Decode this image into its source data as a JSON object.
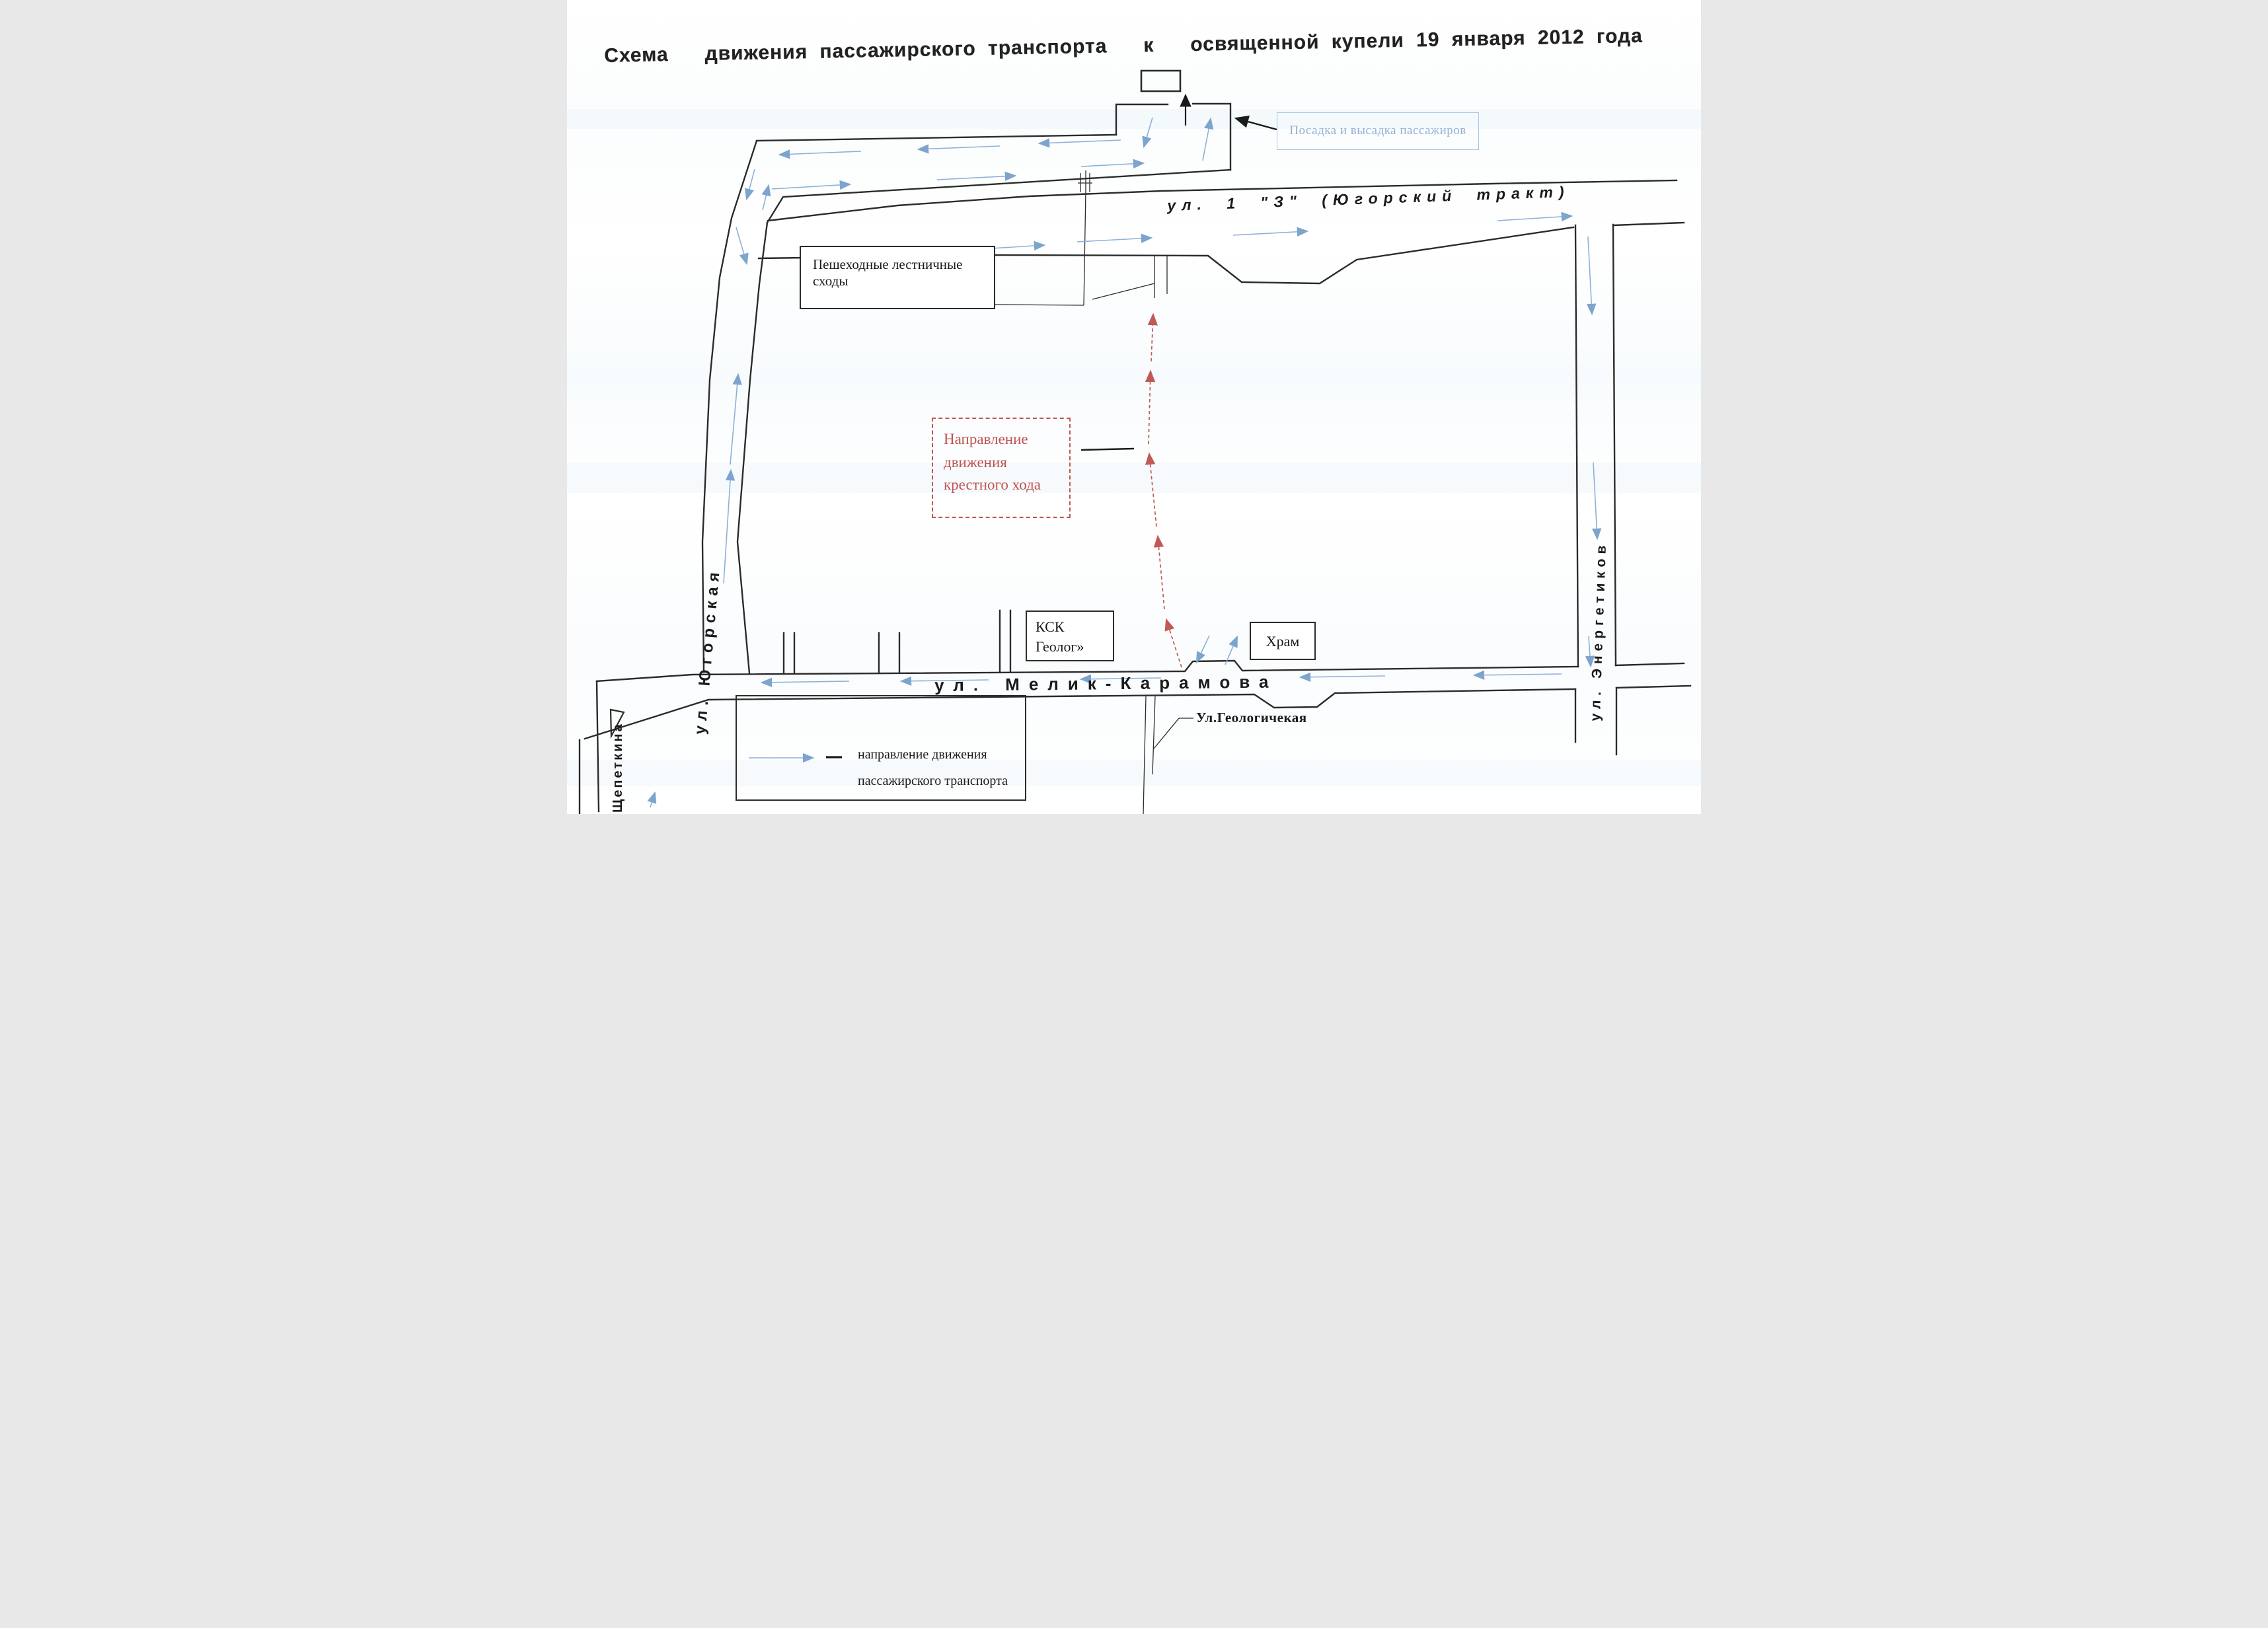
{
  "title": "Схема   движения пассажирского транспорта   к   освященной купели 19 января 2012 года",
  "labels": {
    "boarding": "Посадка и высадка пассажиров",
    "stairs": "Пешеходные лестничные сходы",
    "procession_line1": "Направление",
    "procession_line2": "движения",
    "procession_line3": "крестного хода",
    "ksk_line1": "КСК",
    "ksk_line2": "Геолог»",
    "temple": "Храм",
    "street_1z": "ул. 1 \"З\" (Югорский тракт)",
    "street_melik": "ул. Мелик-Карамова",
    "street_geolog": "Ул.Геологичекая",
    "street_yugorskaya": "ул. Югорская",
    "street_shchepetkina": "ул. Щепеткина",
    "street_energetikov": "ул. Энергетиков",
    "legend_line1": "направление движения",
    "legend_line2": "пассажирского транспорта"
  },
  "colors": {
    "road": "#2b2b2b",
    "transport_arrow": "#7da4cc",
    "procession_arrow": "#c05a55",
    "boarding_box": "#a8c6e2"
  }
}
